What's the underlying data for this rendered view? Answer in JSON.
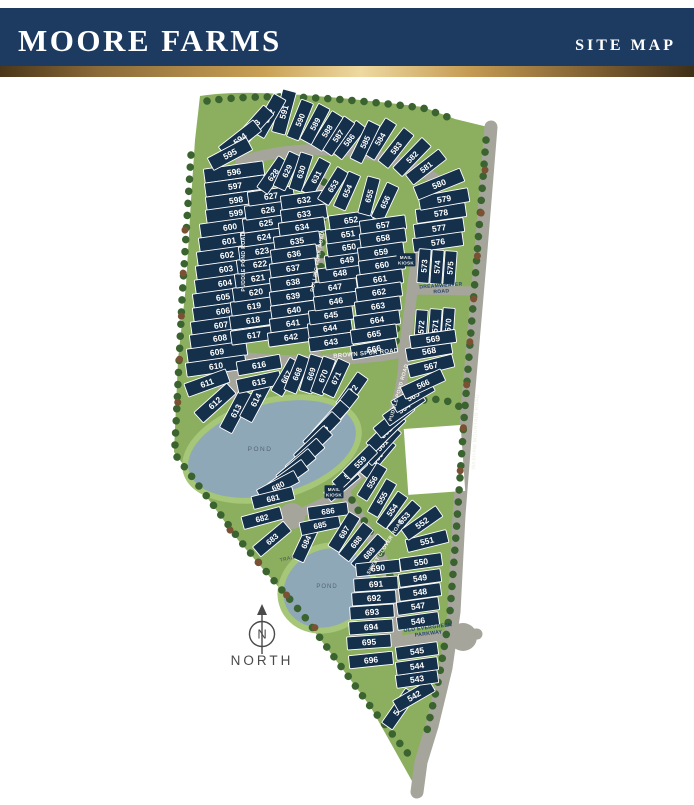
{
  "header": {
    "title": "MOORE FARMS",
    "subtitle": "SITE MAP"
  },
  "compass": {
    "letter": "N",
    "label": "NORTH"
  },
  "colors": {
    "header_bg": "#1d3b60",
    "gold_center": "#eed9a0",
    "lot": "#15304b",
    "lot_line": "#ffffff",
    "road": "#a5a59c",
    "grass": "#8caf5f",
    "pond": "#8fa8b8",
    "pond_halo": "#a6c678",
    "tree": "#3a6330"
  },
  "map": {
    "groups": [
      {
        "w": 60,
        "h": 14,
        "fs": 8.5,
        "lots": [
          [
            596,
            234,
            172,
            -8
          ],
          [
            597,
            235,
            186,
            -8
          ],
          [
            598,
            236,
            200,
            -8
          ],
          [
            599,
            236,
            213,
            -8
          ],
          [
            600,
            230,
            227,
            -8
          ],
          [
            601,
            229,
            241,
            -8
          ],
          [
            602,
            227,
            255,
            -8
          ],
          [
            603,
            226,
            269,
            -8
          ],
          [
            604,
            225,
            283,
            -8
          ],
          [
            605,
            223,
            297,
            -8
          ],
          [
            606,
            223,
            311,
            -8
          ],
          [
            607,
            221,
            325,
            -8
          ],
          [
            608,
            220,
            338,
            -8
          ],
          [
            609,
            217,
            352,
            -8
          ],
          [
            610,
            216,
            366,
            -8
          ]
        ]
      },
      {
        "w": 44,
        "h": 14,
        "fs": 8.5,
        "lots": [
          [
            591,
            284,
            112,
            -75
          ],
          [
            592,
            269,
            116,
            -60
          ],
          [
            593,
            254,
            126,
            -48
          ],
          [
            594,
            240,
            139,
            -38
          ],
          [
            595,
            230,
            154,
            -28
          ]
        ]
      },
      {
        "w": 44,
        "h": 14,
        "fs": 8.5,
        "lots": [
          [
            611,
            207,
            383,
            -20
          ],
          [
            612,
            215,
            403,
            -42
          ],
          [
            613,
            236,
            411,
            -62
          ],
          [
            614,
            256,
            400,
            -62
          ],
          [
            615,
            259,
            382,
            -12
          ],
          [
            616,
            259,
            365,
            -10
          ]
        ]
      },
      {
        "w": 40,
        "h": 13,
        "fs": 8,
        "lots": [
          [
            586,
            349,
            140,
            -52
          ],
          [
            587,
            338,
            136,
            -55
          ],
          [
            588,
            327,
            131,
            -58
          ],
          [
            589,
            315,
            124,
            -62
          ],
          [
            590,
            300,
            120,
            -68
          ]
        ]
      },
      {
        "w": 42,
        "h": 13,
        "fs": 8,
        "lots": [
          [
            581,
            426,
            167,
            -38
          ],
          [
            582,
            412,
            157,
            -46
          ],
          [
            583,
            396,
            148,
            -52
          ],
          [
            584,
            380,
            139,
            -58
          ],
          [
            585,
            365,
            142,
            -64
          ]
        ]
      },
      {
        "w": 50,
        "h": 14,
        "fs": 8.5,
        "lots": [
          [
            576,
            438,
            242,
            -8
          ],
          [
            577,
            439,
            228,
            -8
          ],
          [
            578,
            441,
            213,
            -8
          ],
          [
            579,
            444,
            199,
            -10
          ],
          [
            580,
            439,
            184,
            -22
          ]
        ]
      },
      {
        "w": 46,
        "h": 14,
        "fs": 8.5,
        "lots": [
          [
            617,
            254,
            335,
            -8
          ],
          [
            618,
            253,
            320,
            -8
          ],
          [
            619,
            254,
            306,
            -8
          ],
          [
            620,
            256,
            292,
            -8
          ],
          [
            621,
            258,
            278,
            -8
          ],
          [
            622,
            260,
            264,
            -8
          ],
          [
            623,
            262,
            251,
            -8
          ],
          [
            624,
            264,
            237,
            -8
          ],
          [
            625,
            266,
            223,
            -8
          ],
          [
            626,
            268,
            210,
            -8
          ],
          [
            627,
            271,
            196,
            -8
          ]
        ]
      },
      {
        "w": 38,
        "h": 13,
        "fs": 8,
        "lots": [
          [
            628,
            273,
            175,
            -55
          ],
          [
            629,
            287,
            171,
            -65
          ],
          [
            630,
            301,
            172,
            -72
          ],
          [
            631,
            316,
            177,
            -62
          ]
        ]
      },
      {
        "w": 46,
        "h": 14,
        "fs": 8.5,
        "lots": [
          [
            632,
            304,
            200,
            -8
          ],
          [
            633,
            304,
            214,
            -8
          ],
          [
            634,
            302,
            227,
            -8
          ],
          [
            635,
            297,
            241,
            -8
          ],
          [
            636,
            294,
            254,
            -8
          ],
          [
            637,
            293,
            268,
            -8
          ],
          [
            638,
            293,
            282,
            -8
          ],
          [
            639,
            293,
            296,
            -8
          ],
          [
            640,
            294,
            310,
            -8
          ],
          [
            641,
            293,
            323,
            -8
          ],
          [
            642,
            291,
            337,
            -8
          ]
        ]
      },
      {
        "w": 44,
        "h": 14,
        "fs": 8.5,
        "lots": [
          [
            643,
            331,
            342,
            -8
          ],
          [
            644,
            330,
            328,
            -8
          ],
          [
            645,
            331,
            315,
            -8
          ],
          [
            646,
            336,
            301,
            -8
          ],
          [
            647,
            335,
            287,
            -8
          ],
          [
            648,
            340,
            273,
            -8
          ],
          [
            649,
            347,
            260,
            -8
          ],
          [
            650,
            349,
            247,
            -8
          ],
          [
            651,
            348,
            234,
            -8
          ],
          [
            652,
            351,
            220,
            -8
          ]
        ]
      },
      {
        "w": 38,
        "h": 13,
        "fs": 8,
        "lots": [
          [
            653,
            333,
            186,
            -58
          ],
          [
            654,
            347,
            191,
            -66
          ],
          [
            655,
            369,
            196,
            -75
          ],
          [
            656,
            385,
            202,
            -65
          ]
        ]
      },
      {
        "w": 46,
        "h": 14,
        "fs": 8.5,
        "lots": [
          [
            657,
            383,
            225,
            -8
          ],
          [
            658,
            383,
            238,
            -8
          ],
          [
            659,
            381,
            252,
            -8
          ],
          [
            660,
            382,
            265,
            -8
          ],
          [
            661,
            380,
            279,
            -8
          ],
          [
            662,
            379,
            292,
            -8
          ],
          [
            663,
            378,
            306,
            -8
          ],
          [
            664,
            377,
            320,
            -8
          ],
          [
            665,
            374,
            334,
            -8
          ],
          [
            666,
            374,
            349,
            -10
          ]
        ]
      },
      {
        "w": 34,
        "h": 12,
        "fs": 8,
        "lots": [
          [
            573,
            424,
            266,
            -86
          ],
          [
            574,
            437,
            267,
            -86
          ],
          [
            575,
            450,
            268,
            -86
          ]
        ]
      },
      {
        "w": 34,
        "h": 12,
        "fs": 8,
        "lots": [
          [
            570,
            448,
            325,
            -86
          ],
          [
            571,
            435,
            326,
            -86
          ],
          [
            572,
            421,
            327,
            -86
          ]
        ]
      },
      {
        "w": 46,
        "h": 13,
        "fs": 8.5,
        "lots": [
          [
            567,
            431,
            366,
            -14
          ],
          [
            568,
            429,
            351,
            -10
          ],
          [
            569,
            433,
            339,
            -8
          ]
        ]
      },
      {
        "w": 44,
        "h": 13,
        "fs": 8,
        "lots": [
          [
            560,
            377,
            458,
            -50
          ],
          [
            561,
            382,
            445,
            -48
          ],
          [
            562,
            386,
            432,
            -45
          ],
          [
            563,
            394,
            419,
            -40
          ],
          [
            564,
            404,
            408,
            -35
          ],
          [
            565,
            413,
            396,
            -30
          ],
          [
            566,
            423,
            384,
            -25
          ]
        ]
      },
      {
        "w": 38,
        "h": 12,
        "fs": 8,
        "lots": [
          [
            553,
            404,
            518,
            -48
          ],
          [
            554,
            392,
            510,
            -55
          ],
          [
            555,
            382,
            498,
            -60
          ],
          [
            556,
            372,
            482,
            -58
          ],
          [
            557,
            342,
            485,
            -40
          ],
          [
            558,
            350,
            473,
            -43
          ],
          [
            559,
            360,
            462,
            -45
          ]
        ]
      },
      {
        "w": 42,
        "h": 13,
        "fs": 8.5,
        "lots": [
          [
            546,
            418,
            621,
            -8
          ],
          [
            547,
            418,
            606,
            -8
          ],
          [
            548,
            420,
            592,
            -8
          ],
          [
            549,
            420,
            578,
            -8
          ],
          [
            550,
            421,
            562,
            -8
          ],
          [
            551,
            427,
            541,
            -14
          ],
          [
            552,
            422,
            523,
            -35
          ]
        ]
      },
      {
        "w": 42,
        "h": 13,
        "fs": 8.5,
        "lots": [
          [
            541,
            399,
            709,
            -55
          ],
          [
            542,
            414,
            696,
            -30
          ],
          [
            543,
            417,
            679,
            -8
          ],
          [
            544,
            417,
            666,
            -8
          ],
          [
            545,
            417,
            651,
            -8
          ]
        ]
      },
      {
        "w": 38,
        "h": 13,
        "fs": 8,
        "lots": [
          [
            667,
            286,
            377,
            -60
          ],
          [
            668,
            297,
            374,
            -68
          ],
          [
            669,
            311,
            374,
            -73
          ],
          [
            670,
            323,
            376,
            -70
          ],
          [
            671,
            336,
            378,
            -65
          ],
          [
            672,
            352,
            391,
            -55
          ]
        ]
      },
      {
        "w": 42,
        "h": 13,
        "fs": 8,
        "lots": [
          [
            673,
            341,
            409,
            -52
          ],
          [
            674,
            331,
            420,
            -48
          ],
          [
            675,
            322,
            431,
            -46
          ],
          [
            676,
            313,
            445,
            -44
          ],
          [
            677,
            305,
            457,
            -42
          ],
          [
            678,
            296,
            467,
            -40
          ],
          [
            679,
            288,
            477,
            -36
          ],
          [
            680,
            278,
            486,
            -28
          ],
          [
            681,
            273,
            498,
            -14
          ]
        ]
      },
      {
        "w": 40,
        "h": 13,
        "fs": 8,
        "lots": [
          [
            682,
            262,
            518,
            -15
          ],
          [
            683,
            272,
            539,
            -40
          ],
          [
            684,
            306,
            542,
            -65
          ],
          [
            685,
            320,
            525,
            -12
          ],
          [
            686,
            328,
            511,
            -8
          ],
          [
            687,
            344,
            532,
            -58
          ],
          [
            688,
            356,
            542,
            -52
          ],
          [
            689,
            369,
            553,
            -48
          ]
        ]
      },
      {
        "w": 44,
        "h": 13,
        "fs": 8.5,
        "lots": [
          [
            690,
            378,
            568,
            -6
          ],
          [
            691,
            376,
            584,
            -4
          ],
          [
            692,
            374,
            598,
            -4
          ],
          [
            693,
            372,
            612,
            -4
          ],
          [
            694,
            371,
            627,
            -4
          ],
          [
            695,
            369,
            642,
            -4
          ],
          [
            696,
            371,
            660,
            -6
          ]
        ]
      }
    ],
    "labels": [
      {
        "name": "road-label-puddle-pond-road",
        "text": "PUDDLE POND ROAD",
        "x": 245,
        "y": 262,
        "r": -90,
        "size": 5.2
      },
      {
        "name": "road-label-rolling-fork-road",
        "text": "ROLLING FORK ROAD",
        "x": 319,
        "y": 262,
        "r": -80,
        "size": 5.2
      },
      {
        "name": "road-label-brown-spur-road",
        "text": "BROWN SPUR ROAD",
        "x": 366,
        "y": 355,
        "r": -5,
        "size": 6
      },
      {
        "name": "road-label-puddle-pond-road-2",
        "text": "PUDDLE POND ROAD",
        "x": 400,
        "y": 393,
        "r": -74,
        "size": 5.2
      },
      {
        "name": "road-label-dreamweaver-road",
        "text": "DREAMWEAVER\nROAD",
        "x": 441,
        "y": 287,
        "r": -4,
        "size": 5,
        "color": "#23456b"
      },
      {
        "name": "road-label-sweet-clover-road",
        "text": "SWEET CLOVER ROAD",
        "x": 386,
        "y": 548,
        "r": -58,
        "size": 5.2
      },
      {
        "name": "road-label-old-evergreen-parkway",
        "text": "OLD EVERGREEN\nPARKWAY",
        "x": 428,
        "y": 629,
        "r": -7,
        "size": 5.2,
        "color": "#23456b"
      },
      {
        "name": "road-label-waxhaw-mountain-road",
        "text": "WAXHAW MOUNTAIN ROAD",
        "x": 477,
        "y": 432,
        "r": -87,
        "size": 5.2
      },
      {
        "name": "mail-kiosk-label-1",
        "text": "MAIL\nKIOSK",
        "x": 406,
        "y": 259,
        "box": true,
        "size": 4.6
      },
      {
        "name": "mail-kiosk-label-2",
        "text": "MAIL\nKIOSK",
        "x": 334,
        "y": 491,
        "box": true,
        "size": 4.6
      },
      {
        "name": "pond-label-1",
        "text": "POND",
        "x": 260,
        "y": 451,
        "size": 6.5,
        "color": "#546573",
        "ls": 1.5,
        "bold": false
      },
      {
        "name": "pond-label-2",
        "text": "POND",
        "x": 327,
        "y": 588,
        "size": 6,
        "color": "#546573",
        "ls": 1,
        "bold": false
      },
      {
        "name": "trail-label",
        "text": "TRAIL",
        "x": 288,
        "y": 560,
        "r": -12,
        "size": 5,
        "color": "#5a6a58"
      }
    ]
  }
}
